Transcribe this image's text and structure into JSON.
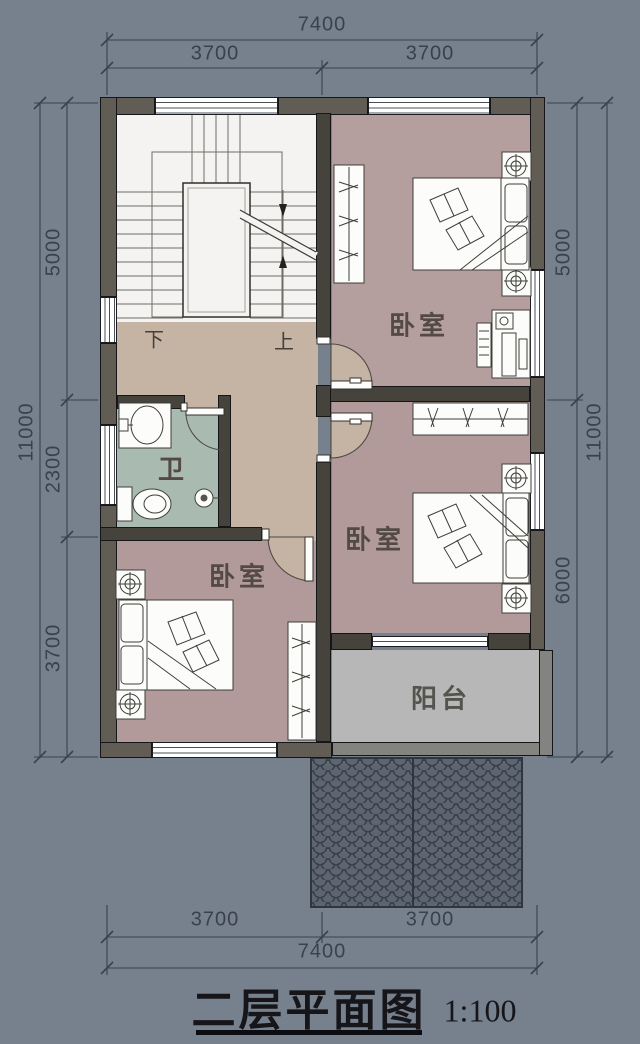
{
  "title": {
    "text": "二层平面图",
    "scale_label": "1:100"
  },
  "dimensions": {
    "top": {
      "total": "7400",
      "seg1": "3700",
      "seg2": "3700"
    },
    "bottom": {
      "total": "7400",
      "seg1": "3700",
      "seg2": "3700"
    },
    "left": {
      "total": "11000",
      "seg1": "5000",
      "seg2": "2300",
      "seg3": "3700"
    },
    "right": {
      "total": "11000",
      "seg1": "5000",
      "seg2": "6000"
    }
  },
  "rooms": {
    "bedroom_top_right": "卧室",
    "bedroom_mid_right": "卧室",
    "bedroom_bottom_left": "卧室",
    "bathroom": "卫",
    "balcony": "阳台",
    "stair_down": "下",
    "stair_up": "上"
  },
  "colors": {
    "background": "#76818d",
    "wall_exterior": "#615d55",
    "wall_interior": "#46433c",
    "wall_outline": "#15161a",
    "floor_stairs": "#f4f3f1",
    "floor_hall": "#c5b3a3",
    "floor_bedroom": "#b29a9a",
    "floor_bath": "#a9bbb1",
    "floor_balcony": "#b7b7b7",
    "roof_tile": "#5c6570",
    "roof_line": "#39404a",
    "dim_color": "#39414d",
    "label_color": "#544a45",
    "title_color": "#15151a"
  }
}
